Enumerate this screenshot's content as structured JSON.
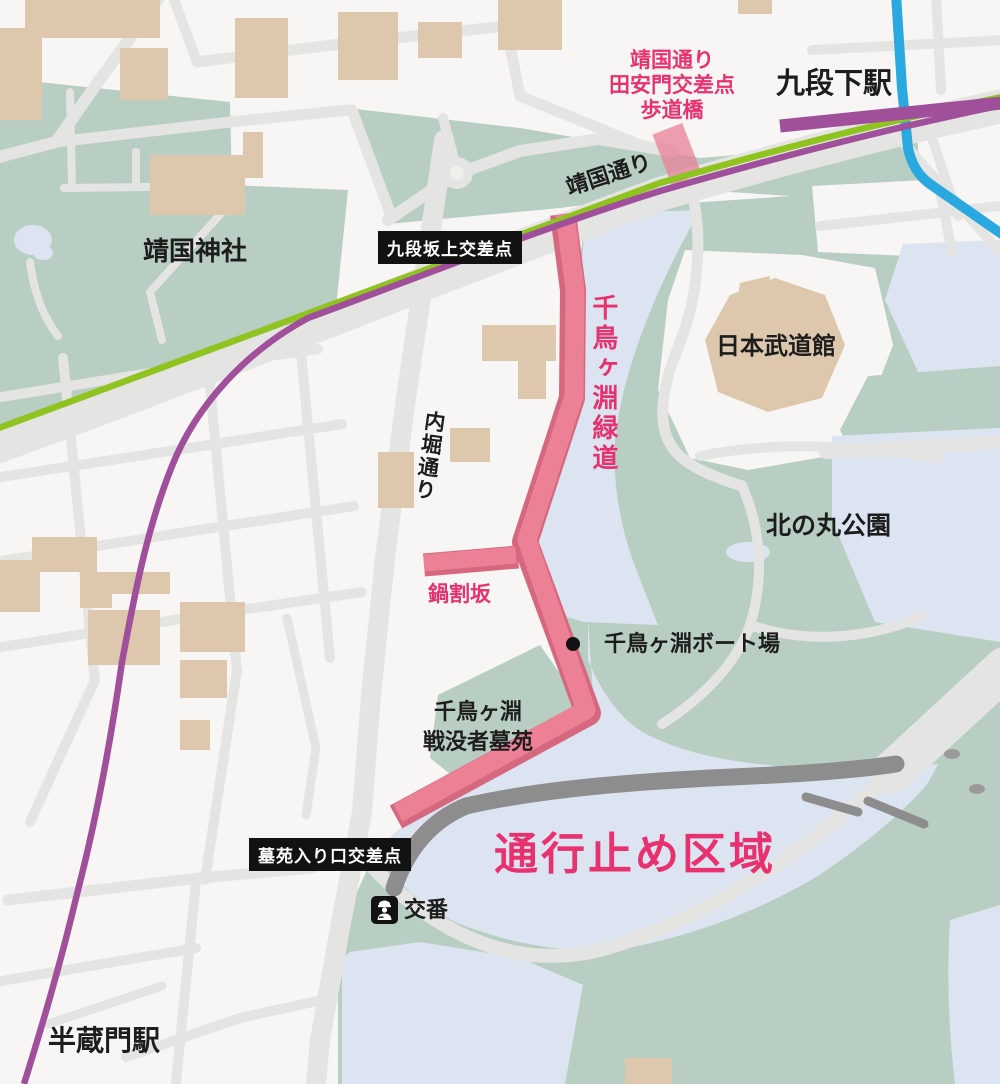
{
  "map": {
    "title_note": "road closure map of Chidorigafuchi area",
    "labels": {
      "bridge_line1": "靖国通り",
      "bridge_line2": "田安門交差点",
      "bridge_line3": "歩道橋",
      "station_kudanshita": "九段下駅",
      "road_yasukuni": "靖国通り",
      "intersection_kudanzaka": "九段坂上交差点",
      "shrine_yasukuni": "靖国神社",
      "greenway_chidorigafuchi": "千鳥ヶ淵緑道",
      "hall_budokan": "日本武道館",
      "park_kitanomaru": "北の丸公園",
      "road_uchibori": "内堀通り",
      "slope_nabewari": "鍋割坂",
      "boat_area": "千鳥ヶ淵ボート場",
      "cemetery_line1": "千鳥ヶ淵",
      "cemetery_line2": "戦没者墓苑",
      "intersection_boen": "墓苑入り口交差点",
      "police_box": "交番",
      "closed_area": "通行止め区域",
      "station_hanzomon": "半蔵門駅"
    },
    "colors": {
      "background": "#f7f6f4",
      "park_green": "#b8cec2",
      "water_blue": "#dce4f2",
      "road_gray": "#e4e4e3",
      "expressway_gray": "#8d8d8d",
      "building_tan": "#ddc8ad",
      "route_pink": "#ec8095",
      "route_edge_pink": "#d5687f",
      "accent_pink_text": "#e8316f",
      "rail_line_green": "#8fc31f",
      "rail_line_purple": "#a0509b",
      "river_blue": "#2aa8e0",
      "badge_black": "#121212"
    }
  }
}
